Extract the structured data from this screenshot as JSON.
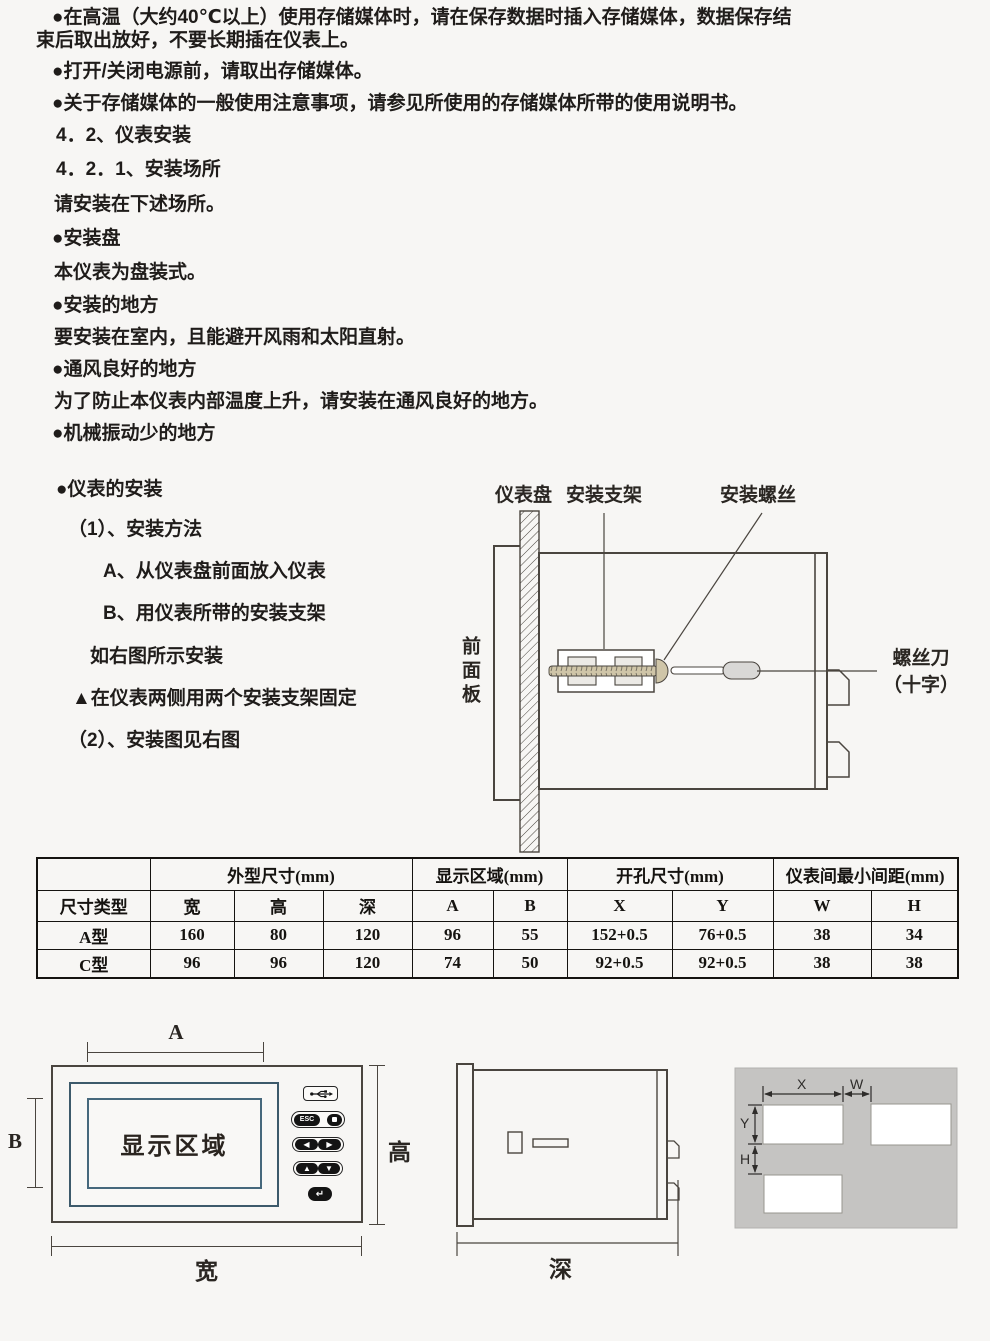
{
  "colors": {
    "page_bg": "#f7f6f4",
    "line": "#4a453f",
    "display_border_blue": "#3d5a6b",
    "cutout_panel_gray": "#c5c4c2",
    "screw_tan": "#cfc5a8"
  },
  "lines": [
    "●在高温（大约40℃以上）使用存储媒体时，请在保存数据时插入存储媒体，数据保存结",
    "束后取出放好，不要长期插在仪表上。",
    "●打开/关闭电源前，请取出存储媒体。",
    "●关于存储媒体的一般使用注意事项，请参见所使用的存储媒体所带的使用说明书。",
    "4．2、仪表安装",
    "4．2．1、安装场所",
    "请安装在下述场所。",
    "●安装盘",
    "本仪表为盘装式。",
    "●安装的地方",
    "要安装在室内，且能避开风雨和太阳直射。",
    "●通风良好的地方",
    "为了防止本仪表内部温度上升，请安装在通风良好的地方。",
    "●机械振动少的地方",
    "●仪表的安装",
    "（1）、安装方法",
    "A、从仪表盘前面放入仪表",
    "B、用仪表所带的安装支架",
    "如右图所示安装",
    "▲在仪表两侧用两个安装支架固定",
    "（2）、安装图见右图"
  ],
  "install_diagram": {
    "labels": {
      "panel": "仪表盘",
      "bracket": "安装支架",
      "screw": "安装螺丝",
      "front_panel": "前面板",
      "screwdriver_line1": "螺丝刀",
      "screwdriver_line2": "（十字）"
    }
  },
  "table": {
    "group_headers": [
      "外型尺寸(mm)",
      "显示区域(mm)",
      "开孔尺寸(mm)",
      "仪表间最小间距(mm)"
    ],
    "col_headers": [
      "尺寸类型",
      "宽",
      "高",
      "深",
      "A",
      "B",
      "X",
      "Y",
      "W",
      "H"
    ],
    "rows": [
      [
        "A型",
        "160",
        "80",
        "120",
        "96",
        "55",
        "152+0.5",
        "76+0.5",
        "38",
        "34"
      ],
      [
        "C型",
        "96",
        "96",
        "120",
        "74",
        "50",
        "92+0.5",
        "92+0.5",
        "38",
        "38"
      ]
    ]
  },
  "front_view": {
    "display_area": "显示区域",
    "esc": "ESC",
    "buttons": {
      "left": "◀",
      "right": "▶",
      "up": "▲",
      "down": "▼",
      "enter": "↵"
    },
    "dims": {
      "a": "A",
      "b": "B",
      "width": "宽",
      "height": "高"
    }
  },
  "side_view": {
    "dims": {
      "depth": "深"
    }
  },
  "cutout_view": {
    "dims": {
      "x": "X",
      "w": "W",
      "y": "Y",
      "h": "H"
    }
  }
}
